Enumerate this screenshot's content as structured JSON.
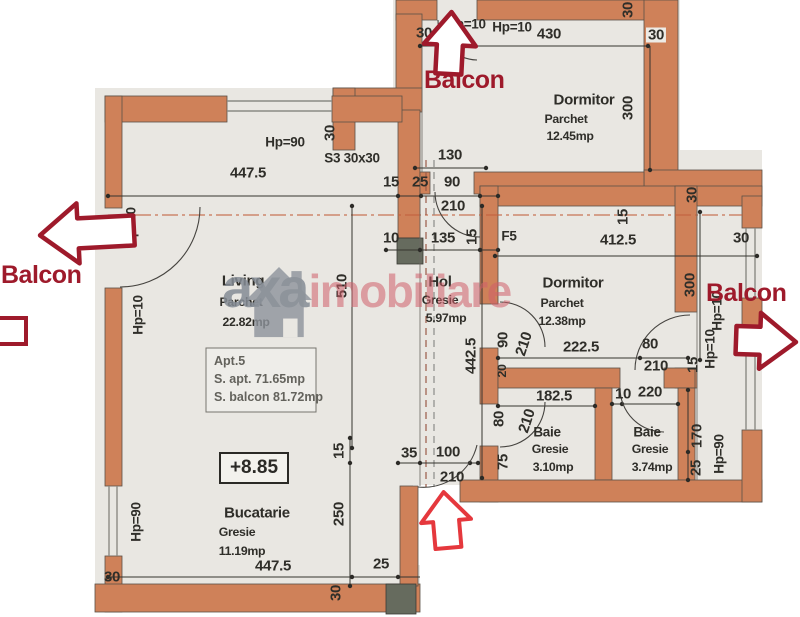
{
  "plan": {
    "balcony": {
      "top": "Balcon",
      "left": "Balcon",
      "right": "Balcon"
    },
    "watermark": {
      "gray": "axa",
      "red": "imobiliare"
    },
    "apt_box": {
      "l1": "Apt.5",
      "l2": "S. apt. 71.65mp",
      "l3": "S. balcon 81.72mp"
    },
    "level": "+8.85",
    "rooms": {
      "dormitor_top": {
        "name": "Dormitor",
        "floor": "Parchet",
        "area": "12.45mp"
      },
      "living": {
        "name": "Living",
        "floor": "Parchet",
        "area": "22.82mp"
      },
      "hol": {
        "name": "Hol",
        "floor": "Gresie",
        "area": "5.97mp"
      },
      "dormitor_right": {
        "name": "Dormitor",
        "floor": "Parchet",
        "area": "12.38mp"
      },
      "baie1": {
        "name": "Baie",
        "floor": "Gresie",
        "area": "3.10mp"
      },
      "baie2": {
        "name": "Baie",
        "floor": "Gresie",
        "area": "3.74mp"
      },
      "bucatarie": {
        "name": "Bucatarie",
        "floor": "Gresie",
        "area": "11.19mp"
      }
    },
    "dims": {
      "hp10_a": "Hp=10",
      "hp10_b": "Hp=10",
      "d430": "430",
      "t30_tl": "30",
      "t30_tr": "30",
      "v30_tr": "30",
      "v300_top": "300",
      "d130": "130",
      "d15_top": "15",
      "d25_top": "25",
      "d90_top": "90",
      "d210_top": "210",
      "s3": "S3 30x30",
      "v30_s3": "30",
      "hp90_top": "Hp=90",
      "d447_top": "447.5",
      "hp10_l1": "Hp=10",
      "hp10_l2": "Hp=10",
      "v510": "510",
      "d10_hol": "10",
      "d135": "135",
      "v15_hol": "15",
      "v442": "442.5",
      "f5": "F5",
      "d412": "412.5",
      "v15_dtop": "15",
      "r30_ext": "30",
      "d30_ext": "30",
      "v300_r": "300",
      "hp10_r1": "Hp=10",
      "hp10_r2": "Hp=10",
      "v15_r": "15",
      "d222": "222.5",
      "d80_dr": "80",
      "d210_dr": "210",
      "v90_door": "90",
      "r210_door": "210",
      "v20": "20",
      "d182": "182.5",
      "v80_b1": "80",
      "r210_b1": "210",
      "v75_b1": "75",
      "d10_b2": "10",
      "d220": "220",
      "v170": "170",
      "v25_b2": "25",
      "hp90_r": "Hp=90",
      "v15_buc": "15",
      "v250": "250",
      "hp90_l": "Hp=90",
      "d447_bot": "447.5",
      "d25_bot": "25",
      "d30_bl": "30",
      "r30_bb": "30",
      "d35": "35",
      "d100": "100",
      "d210_buc": "210"
    }
  }
}
